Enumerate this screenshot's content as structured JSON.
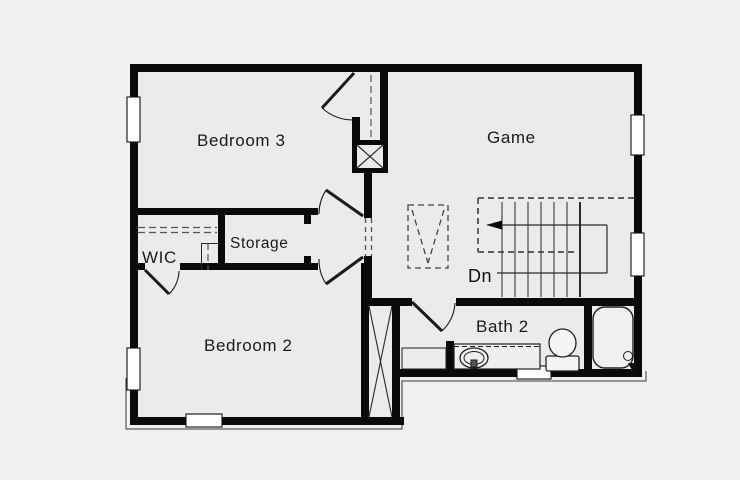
{
  "floor_plan": {
    "rooms": [
      {
        "id": "bedroom3",
        "label": "Bedroom 3"
      },
      {
        "id": "game",
        "label": "Game"
      },
      {
        "id": "wic",
        "label": "WIC"
      },
      {
        "id": "storage",
        "label": "Storage"
      },
      {
        "id": "bedroom2",
        "label": "Bedroom 2"
      },
      {
        "id": "bath2",
        "label": "Bath 2"
      }
    ],
    "stairs": {
      "down_label": "Dn"
    },
    "fixtures": [
      "bathtub",
      "toilet",
      "sink-vanity",
      "stair-treads",
      "attic-chase",
      "closet-rod"
    ],
    "colors": {
      "wall": "#0a0a0a",
      "background": "#f1f0ef",
      "floor": "#ecebea",
      "text": "#1b1b1b",
      "dashed": "#5f5f5f"
    }
  }
}
